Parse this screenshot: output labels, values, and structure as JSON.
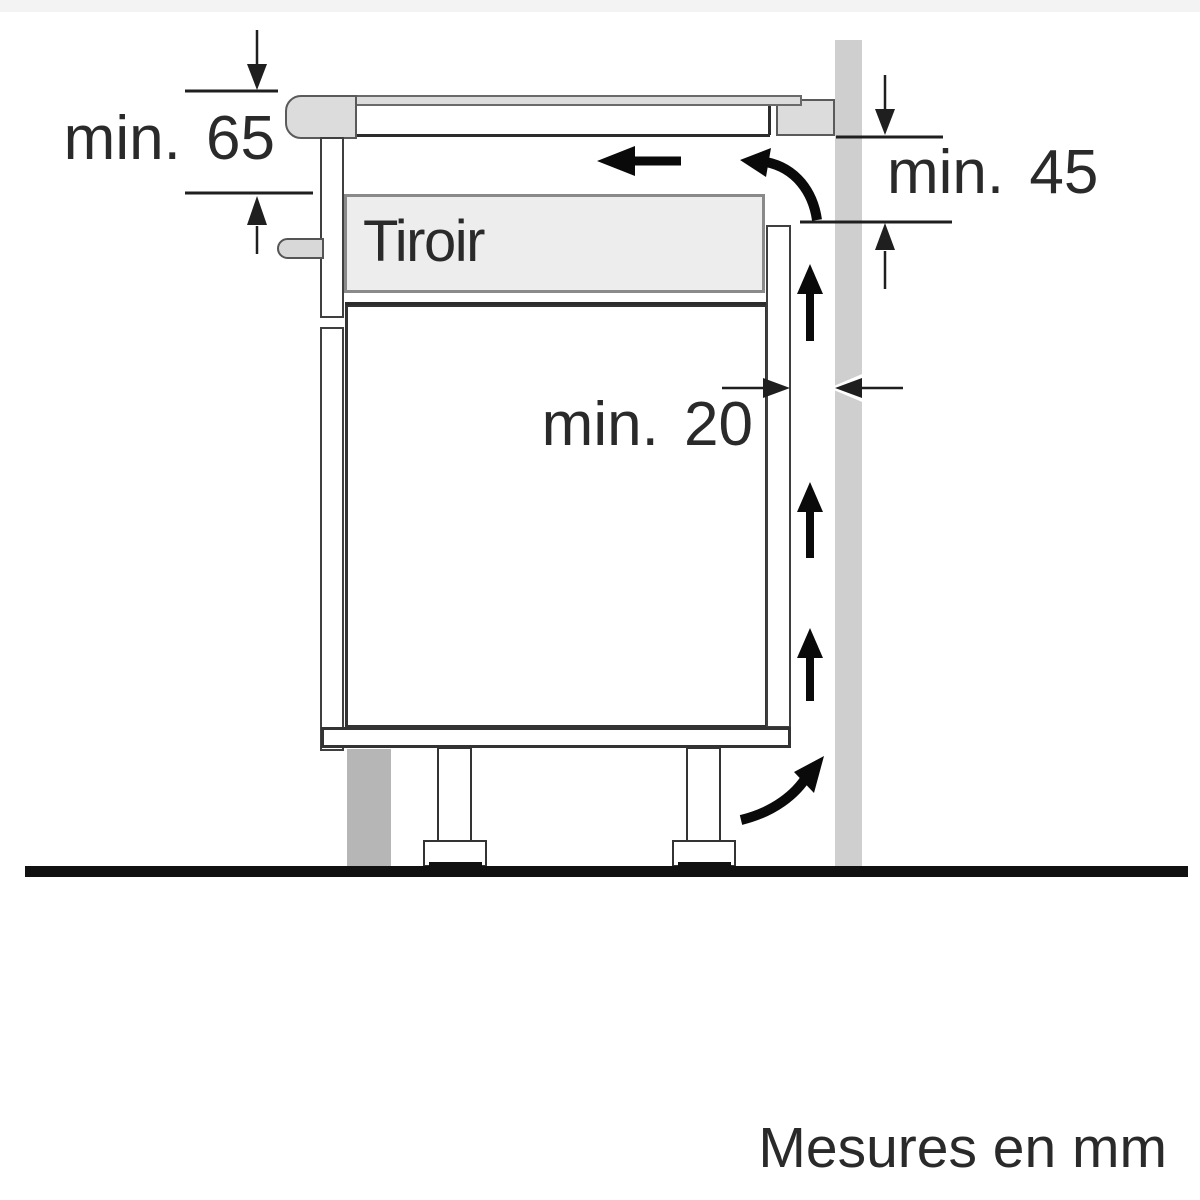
{
  "diagram": {
    "labels": {
      "drawer": "Tiroir",
      "clearance_worktop_to_drawer": "min. 65",
      "clearance_rear_vent_height": "min. 45",
      "clearance_rear_gap": "min. 20"
    },
    "units_note": "Mesures en mm",
    "colors": {
      "wall": "#cfcfcf",
      "plinth": "#b6b6b6",
      "worktop_fill": "#dcdcdc",
      "drawer_fill": "#ededed",
      "outline": "#2c2c2c",
      "arrow": "#0a0a0a"
    }
  }
}
